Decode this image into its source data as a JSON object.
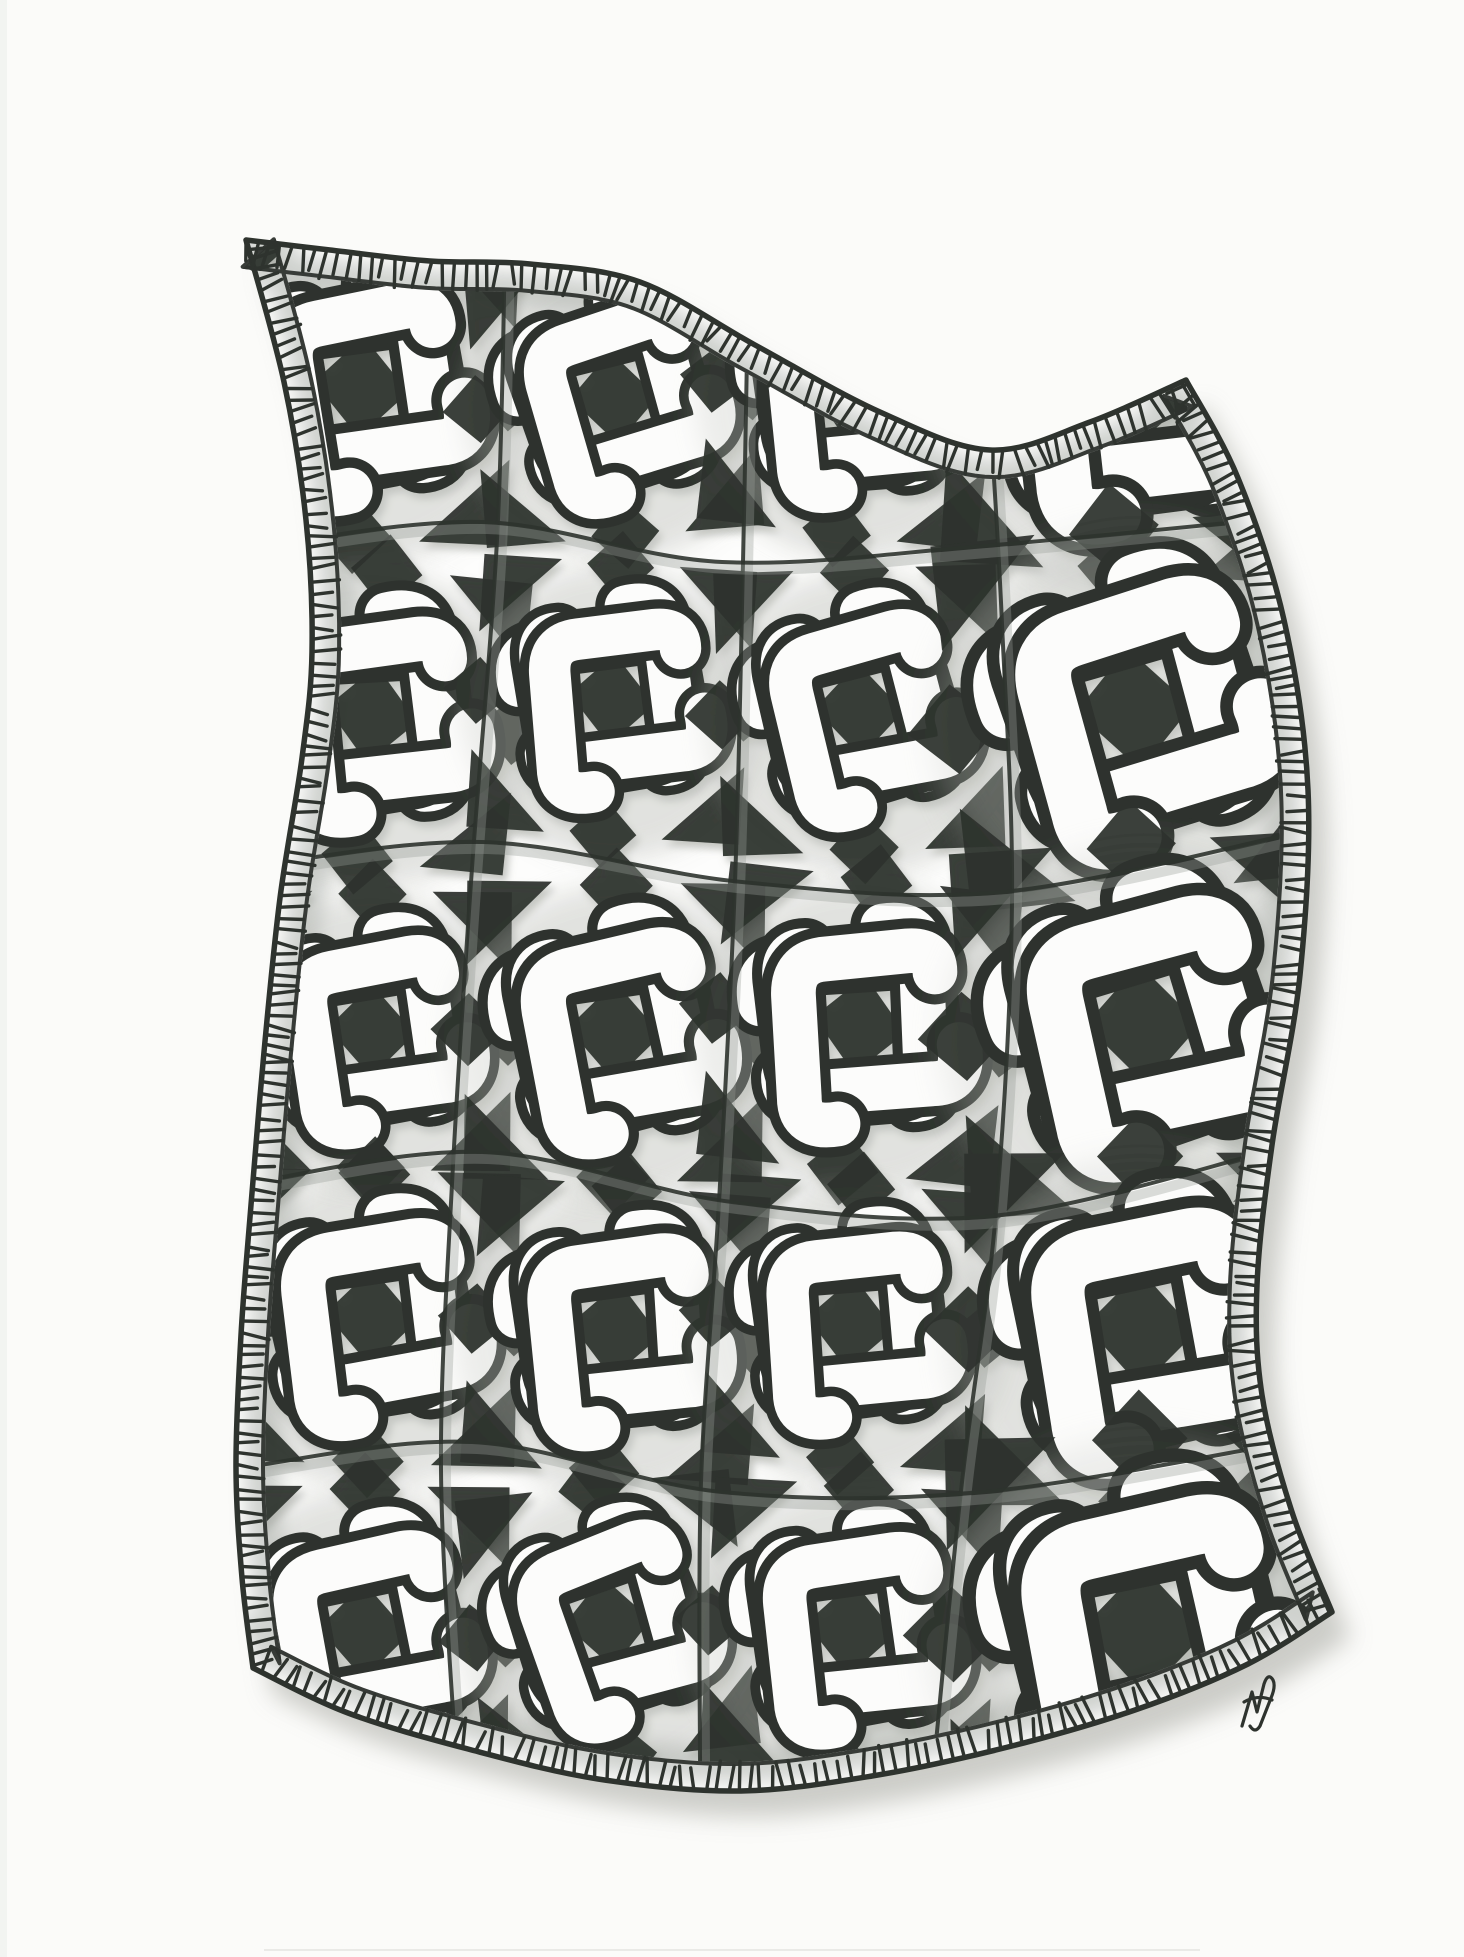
{
  "artwork": {
    "title": "Hand-drawn knotted weave quilt tangle",
    "description": "Scanned pen-and-ink drawing of a wavy quilt shape filled with an interlaced Celtic pinwheel knot pattern, hatched binding border, graphite pencil shading and a small artist monogram at the lower right.",
    "medium": "black ink and graphite pencil on white paper",
    "palette": {
      "paper": "#fbfbf9",
      "quilt_paper": "#fdfdfc",
      "ink": "#2e332e",
      "band_core": "#fcfcfb",
      "pencil": "#979d97",
      "pencil_soft": "#c7c9c4",
      "shadow": "#c4c5c0"
    },
    "seed": 7,
    "outline": {
      "top": [
        [
          246,
          240
        ],
        [
          330,
          250
        ],
        [
          430,
          261
        ],
        [
          530,
          264
        ],
        [
          640,
          282
        ],
        [
          755,
          345
        ],
        [
          880,
          412
        ],
        [
          990,
          450
        ],
        [
          1090,
          422
        ],
        [
          1186,
          380
        ]
      ],
      "right": [
        [
          1186,
          380
        ],
        [
          1238,
          478
        ],
        [
          1284,
          620
        ],
        [
          1308,
          790
        ],
        [
          1300,
          975
        ],
        [
          1272,
          1145
        ],
        [
          1257,
          1285
        ],
        [
          1262,
          1395
        ],
        [
          1292,
          1512
        ],
        [
          1332,
          1612
        ]
      ],
      "bottom": [
        [
          1332,
          1612
        ],
        [
          1248,
          1664
        ],
        [
          1135,
          1710
        ],
        [
          1008,
          1747
        ],
        [
          872,
          1776
        ],
        [
          738,
          1791
        ],
        [
          598,
          1779
        ],
        [
          468,
          1749
        ],
        [
          348,
          1713
        ],
        [
          253,
          1668
        ]
      ],
      "left": [
        [
          253,
          1668
        ],
        [
          242,
          1578
        ],
        [
          236,
          1468
        ],
        [
          241,
          1335
        ],
        [
          251,
          1205
        ],
        [
          264,
          1052
        ],
        [
          280,
          898
        ],
        [
          302,
          758
        ],
        [
          312,
          652
        ],
        [
          306,
          520
        ],
        [
          284,
          382
        ],
        [
          246,
          240
        ]
      ]
    },
    "centroid": [
      772,
      1012
    ],
    "binding": {
      "inset": 27,
      "tick_spacing": 11,
      "tick_min": 20,
      "tick_max": 30,
      "outer_width": 5.5,
      "inner_width": 4
    },
    "grid": {
      "col_bounds": [
        246,
        492,
        734,
        978,
        1300
      ],
      "row_bounds": [
        240,
        548,
        866,
        1182,
        1468,
        1792
      ]
    },
    "grid_lines": {
      "vertical": [
        [
          [
            505,
            246
          ],
          [
            497,
            540
          ],
          [
            472,
            868
          ],
          [
            452,
            1184
          ],
          [
            441,
            1470
          ],
          [
            456,
            1758
          ]
        ],
        [
          [
            748,
            300
          ],
          [
            743,
            562
          ],
          [
            735,
            882
          ],
          [
            719,
            1202
          ],
          [
            701,
            1482
          ],
          [
            700,
            1768
          ]
        ],
        [
          [
            992,
            446
          ],
          [
            1002,
            624
          ],
          [
            1012,
            902
          ],
          [
            996,
            1212
          ],
          [
            962,
            1482
          ],
          [
            936,
            1742
          ]
        ]
      ],
      "horizontal": [
        [
          [
            250,
            548
          ],
          [
            482,
            522
          ],
          [
            722,
            562
          ],
          [
            982,
            546
          ],
          [
            1258,
            520
          ]
        ],
        [
          [
            242,
            868
          ],
          [
            482,
            842
          ],
          [
            742,
            882
          ],
          [
            1002,
            892
          ],
          [
            1300,
            832
          ]
        ],
        [
          [
            244,
            1184
          ],
          [
            482,
            1152
          ],
          [
            732,
            1202
          ],
          [
            992,
            1216
          ],
          [
            1266,
            1152
          ]
        ],
        [
          [
            240,
            1468
          ],
          [
            472,
            1442
          ],
          [
            722,
            1492
          ],
          [
            982,
            1492
          ],
          [
            1290,
            1442
          ]
        ]
      ]
    },
    "motif": {
      "arm_d": "M -70,-6 Q -78,-32 -55,-35 L 14,-48 Q 37,-52 42,-30 L 55,26 Q 59,45 43,47",
      "arm_outline_width": 45,
      "arm_core_width": 31,
      "arms": 4,
      "local_extent": 205,
      "overscale": 1.16,
      "dark_shapes": [
        "M 0,-34 L 32,2 L 0,34 L -32,-2 Z",
        "M -102,-102 L -44,-102 L -102,-44 Z",
        "M 102,-102 L 102,-44 L 44,-102 Z",
        "M 102,102 L 44,102 L 102,44 Z",
        "M -102,102 L -102,44 L -44,102 Z",
        "M 0,-126 L 25,-100 L 0,-74 L -25,-100 Z",
        "M 126,0 L 100,25 L 74,0 L 100,-25 Z",
        "M 0,126 L -25,100 L 0,74 L 25,100 Z",
        "M -126,0 L -100,-25 L -74,0 L -100,25 Z"
      ]
    },
    "signature": {
      "kind": "artist-monogram",
      "x": 1254,
      "y": 1703,
      "d": "M 1242,1726 L 1252,1692 L 1257,1712 L 1264,1684 Q 1268,1672 1273,1680 Q 1276,1686 1271,1698 L 1260,1726 Q 1255,1734 1250,1726 M 1244,1702 Q 1258,1694 1272,1700"
    }
  }
}
